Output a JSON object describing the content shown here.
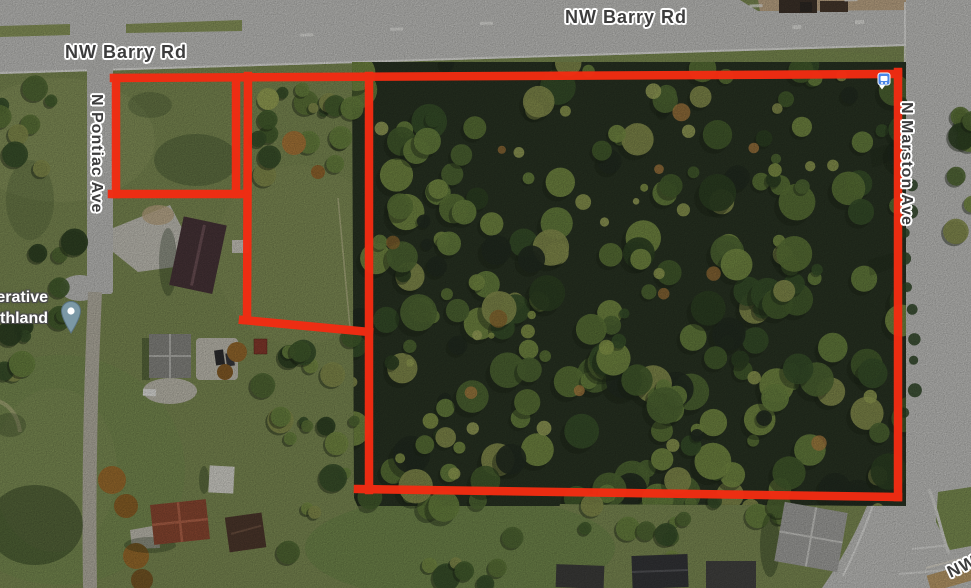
{
  "map": {
    "road_labels": {
      "barry_top": "NW Barry Rd",
      "barry_left": "NW Barry Rd",
      "pontiac": "N Pontiac Ave",
      "marston": "N Marston Ave",
      "bottom_right_partial": "NW"
    },
    "place_label": {
      "line1": "erative",
      "line2": "thland"
    },
    "overlay": {
      "boundary_color": "#f22c12"
    },
    "markers": {
      "place_pin_color": "#7b98a6",
      "transit_icon_color": "#4a86e8"
    },
    "label_colors": {
      "road_text": "#3d3d3d",
      "place_text": "#ffffff"
    }
  }
}
